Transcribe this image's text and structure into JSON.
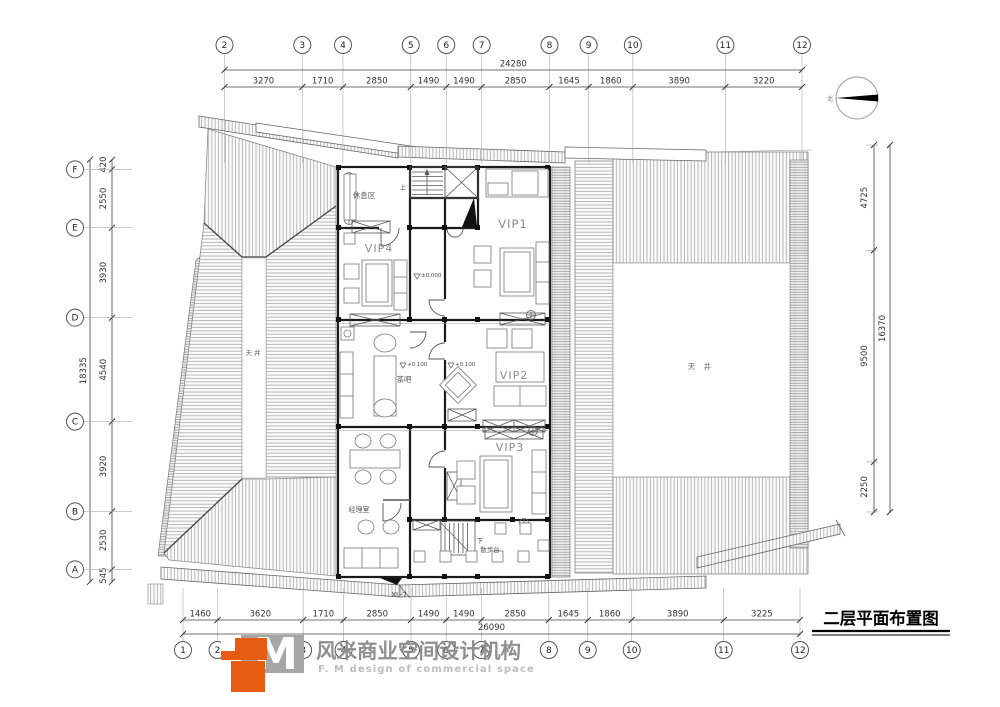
{
  "title": {
    "text": "二层平面布置图"
  },
  "north": {
    "label": "北"
  },
  "logo": {
    "mark": "M",
    "cn": "风米商业空间设计机构",
    "en": "F. M design of commercial space",
    "orange": "#e65c12",
    "gray": "#a6a6a6"
  },
  "plan": {
    "rooms": {
      "rest": "休息区",
      "vip1": "VIP1",
      "vip2": "VIP2",
      "vip3": "VIP3",
      "vip4": "VIP4",
      "tea": "茶吧",
      "manager": "经理室",
      "terrace": "散步台",
      "courtyard_left": "天 井",
      "courtyard_right": "天 井"
    },
    "marks": {
      "lv0": "±0.000",
      "lv_tea": "+0.100",
      "lv_vip2": "+0.100",
      "stair_up": "上",
      "stair_down": "下",
      "beam": "XL-7"
    }
  },
  "grid": {
    "top": {
      "bubbles": [
        "2",
        "3",
        "4",
        "5",
        "6",
        "7",
        "8",
        "9",
        "10",
        "11",
        "12"
      ],
      "dims": [
        3270,
        1710,
        2850,
        1490,
        1490,
        2850,
        1645,
        1860,
        3890,
        3220
      ],
      "total": "24280"
    },
    "bottom": {
      "bubbles": [
        "1",
        "2",
        "3",
        "4",
        "5",
        "6",
        "7",
        "8",
        "9",
        "10",
        "11",
        "12"
      ],
      "dims": [
        1460,
        3620,
        1710,
        2850,
        1490,
        1490,
        2850,
        1645,
        1860,
        3890,
        3225
      ],
      "total": "26090"
    },
    "left": {
      "bubbles": [
        "F",
        "E",
        "D",
        "C",
        "B",
        "A"
      ],
      "dims": [
        420,
        2550,
        3930,
        4540,
        3920,
        2530,
        545
      ],
      "total": "18335"
    },
    "right": {
      "dims": [
        4725,
        9500,
        2250
      ],
      "total": "16370"
    }
  }
}
